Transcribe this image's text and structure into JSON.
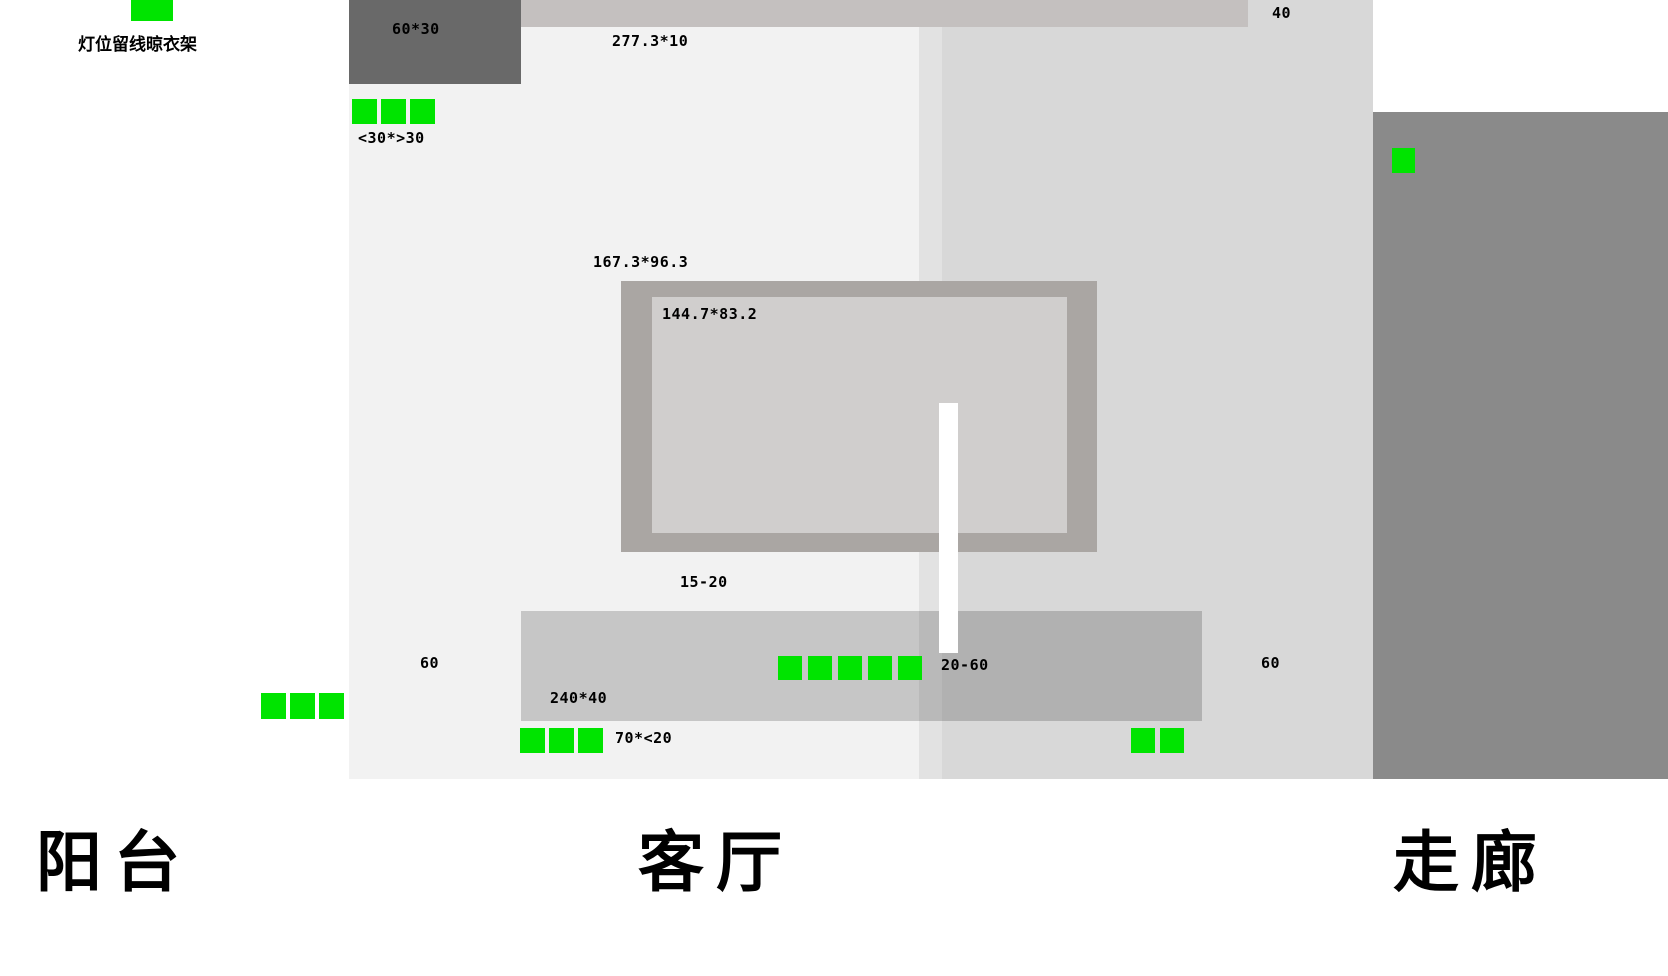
{
  "canvas": {
    "width": 1668,
    "height": 976
  },
  "colors": {
    "light_green": "#00e400",
    "balcony_bg": "#ffffff",
    "living_bg": "#f2f2f2",
    "strip_bg": "#e2e2e2",
    "right_zone_bg": "#d8d8d8",
    "corridor_bg": "#8a8a8a",
    "cabinet": "#696969",
    "beam": "#c4c0bf",
    "tv_frame": "#aaa6a3",
    "tv_screen": "#d0cecd",
    "stand_bar": "#ffffff",
    "sofa_overlay": "rgba(0,0,0,0.18)"
  },
  "rooms": {
    "balcony": {
      "label": "阳台"
    },
    "living_room": {
      "label": "客厅"
    },
    "corridor": {
      "label": "走廊"
    }
  },
  "notes": {
    "clothes_rack": "灯位留线晾衣架"
  },
  "dimensions": {
    "cabinet": "60*30",
    "beam_thickness": "16",
    "beam_span": "277.3*10",
    "beam_right": "40",
    "top_spot_row": "<30*>30",
    "tv_outer": "167.3*96.3",
    "tv_screen": "144.7*83.2",
    "tv_gap": "15-20",
    "left_gap": "60",
    "right_gap": "60",
    "mid_spot_row": "20-60",
    "sofa_wall": "240*40",
    "bottom_spot_row": "70*<20"
  },
  "lights": {
    "clothes_rack_marker_count": 1,
    "top_row_count": 3,
    "balcony_row_count": 3,
    "mid_row_count": 5,
    "bottom_row_count": 3,
    "right_pair_count": 2,
    "corridor_count": 1
  }
}
